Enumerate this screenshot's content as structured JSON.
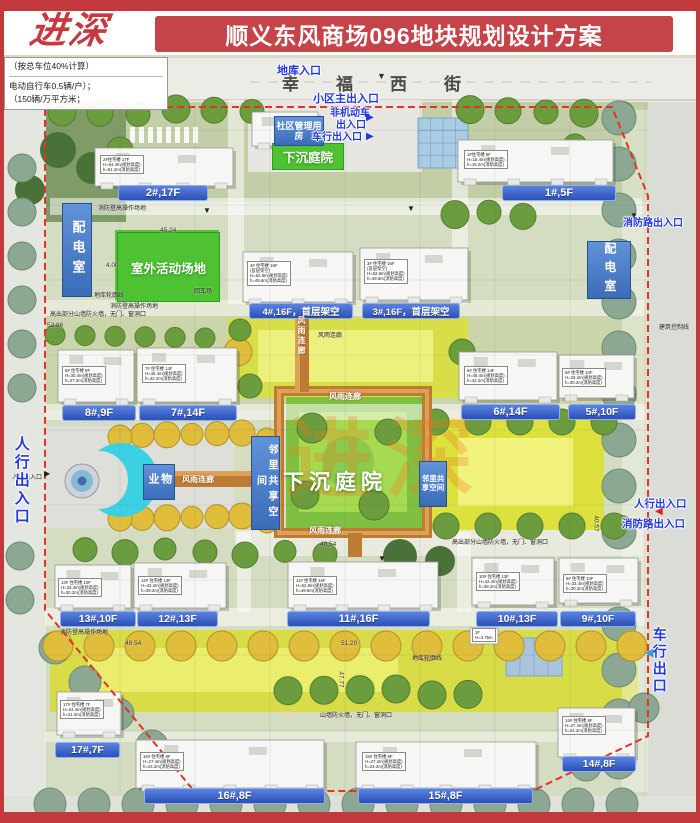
{
  "header": {
    "logo": "进深",
    "title": "顺义东风商场096地块规划设计方案"
  },
  "colors": {
    "frame_red": "#c2393c",
    "title_red": "#c5444a",
    "label_bar_blue": "#3a63cc",
    "entry_blue": "#2337e0",
    "corridor_orange": "#bd7c32",
    "facility_blue": "#4a7ac8",
    "green": "#4ec232",
    "watermark_orange": "#e67d19",
    "boundary_red": "#e63226",
    "gate_cyan": "#3ad2e2"
  },
  "plan": {
    "street_name": "幸福西街",
    "notes_panel": [
      "（按总车位40%计算）",
      "电动自行车0.5辆/户）；",
      "（150辆/万平方米；"
    ],
    "watermark": "进深",
    "building_labels": [
      {
        "t": "2#,17F",
        "x": 118,
        "y": 185,
        "w": 88,
        "fs": 11
      },
      {
        "t": "1#,5F",
        "x": 502,
        "y": 185,
        "w": 112,
        "fs": 11
      },
      {
        "t": "4#,16F，首层架空",
        "x": 249,
        "y": 303,
        "w": 102,
        "fs": 9.5
      },
      {
        "t": "3#,16F，首层架空",
        "x": 362,
        "y": 303,
        "w": 96,
        "fs": 9.5
      },
      {
        "t": "8#,9F",
        "x": 62,
        "y": 405,
        "w": 72,
        "fs": 11
      },
      {
        "t": "7#,14F",
        "x": 139,
        "y": 405,
        "w": 96,
        "fs": 11
      },
      {
        "t": "6#,14F",
        "x": 461,
        "y": 404,
        "w": 97,
        "fs": 11
      },
      {
        "t": "5#,10F",
        "x": 568,
        "y": 404,
        "w": 66,
        "fs": 10.5
      },
      {
        "t": "13#,10F",
        "x": 60,
        "y": 611,
        "w": 74,
        "fs": 10.5
      },
      {
        "t": "12#,13F",
        "x": 137,
        "y": 611,
        "w": 79,
        "fs": 10.5
      },
      {
        "t": "11#,16F",
        "x": 287,
        "y": 611,
        "w": 141,
        "fs": 11
      },
      {
        "t": "10#,13F",
        "x": 476,
        "y": 611,
        "w": 80,
        "fs": 10.5
      },
      {
        "t": "9#,10F",
        "x": 560,
        "y": 611,
        "w": 74,
        "fs": 10.5
      },
      {
        "t": "17#,7F",
        "x": 55,
        "y": 742,
        "w": 63,
        "fs": 10.5
      },
      {
        "t": "16#,8F",
        "x": 144,
        "y": 788,
        "w": 179,
        "fs": 11
      },
      {
        "t": "15#,8F",
        "x": 358,
        "y": 788,
        "w": 173,
        "fs": 11
      },
      {
        "t": "14#,8F",
        "x": 562,
        "y": 756,
        "w": 72,
        "fs": 10.5
      }
    ],
    "facility_labels": [
      {
        "t": "配电室",
        "x": 62,
        "y": 203,
        "w": 28,
        "h": 92,
        "v": 1,
        "fs": 13
      },
      {
        "t": "配电室",
        "x": 587,
        "y": 241,
        "w": 42,
        "h": 56,
        "v": 1,
        "fs": 12
      },
      {
        "t": "物业",
        "x": 143,
        "y": 464,
        "w": 30,
        "h": 34,
        "v": 1,
        "fs": 11
      },
      {
        "t": "社区管理用房",
        "x": 274,
        "y": 116,
        "w": 48,
        "h": 28,
        "fs": 9
      },
      {
        "t": "邻里共享空间",
        "x": 251,
        "y": 436,
        "w": 27,
        "h": 92,
        "v": 1,
        "fs": 10
      },
      {
        "t": "邻里共享空间",
        "x": 419,
        "y": 461,
        "w": 26,
        "h": 44,
        "fs": 7.5
      }
    ],
    "green_labels": [
      {
        "t": "下沉庭院",
        "x": 272,
        "y": 143,
        "w": 70,
        "h": 25,
        "fs": 12.5
      },
      {
        "t": "室外活动场地",
        "x": 117,
        "y": 232,
        "w": 101,
        "h": 68,
        "fs": 12.5
      }
    ],
    "courtyard_label": {
      "t": "下沉庭院"
    },
    "entrance_labels": [
      {
        "t": "地库入口",
        "x": 277,
        "y": 66,
        "fs": 11
      },
      {
        "t": "小区主出入口",
        "x": 313,
        "y": 94,
        "fs": 11
      },
      {
        "t": "非机动车",
        "x": 330,
        "y": 109,
        "fs": 10
      },
      {
        "t": "出入口",
        "x": 336,
        "y": 121,
        "fs": 10
      },
      {
        "t": "车行出入口",
        "x": 312,
        "y": 133,
        "fs": 10
      },
      {
        "t": "消防路出入口",
        "x": 623,
        "y": 219,
        "fs": 10
      },
      {
        "t": "人行出入口",
        "x": 13,
        "y": 436,
        "fs": 15,
        "v": 1,
        "h": 92
      },
      {
        "t": "人行出入口",
        "x": 634,
        "y": 499,
        "fs": 10.5
      },
      {
        "t": "消防路出入口",
        "x": 622,
        "y": 519,
        "fs": 10.5
      },
      {
        "t": "车行出口",
        "x": 652,
        "y": 627,
        "fs": 14,
        "v": 1,
        "h": 64
      }
    ],
    "corridor_labels": [
      {
        "t": "风雨连廊",
        "x": 329,
        "y": 391
      },
      {
        "t": "风雨连廊",
        "x": 309,
        "y": 525
      },
      {
        "t": "风雨连廊",
        "x": 182,
        "y": 474
      },
      {
        "t": "风雨连廊",
        "x": 296,
        "y": 316,
        "v": 1,
        "h": 56
      }
    ],
    "small_notes": [
      {
        "t": "消防登高操作场地",
        "x": 98,
        "y": 203
      },
      {
        "t": "消防登高操作场地",
        "x": 110,
        "y": 301
      },
      {
        "t": "消防登高操作场地",
        "x": 60,
        "y": 627
      },
      {
        "t": "地库轮廓线",
        "x": 94,
        "y": 290
      },
      {
        "t": "地库轮廓线",
        "x": 412,
        "y": 653
      },
      {
        "t": "高出部分山墙防火墙，无门、窗洞口",
        "x": 50,
        "y": 309
      },
      {
        "t": "高出部分山墙防火墙，无门、窗洞口",
        "x": 452,
        "y": 537
      },
      {
        "t": "山墙防火墙，无门、窗洞口",
        "x": 320,
        "y": 710
      },
      {
        "t": "建筑控制线",
        "x": 659,
        "y": 322
      },
      {
        "t": "回车场",
        "x": 194,
        "y": 286
      },
      {
        "t": "风雨连廊",
        "x": 318,
        "y": 330
      },
      {
        "t": "人行出入口",
        "x": 12,
        "y": 472
      }
    ],
    "dimensions": [
      {
        "t": "45.24",
        "x": 160,
        "y": 227
      },
      {
        "t": "52.86",
        "x": 47,
        "y": 322
      },
      {
        "t": "4.00",
        "x": 106,
        "y": 262
      },
      {
        "t": "48.54",
        "x": 125,
        "y": 640
      },
      {
        "t": "48.54",
        "x": 320,
        "y": 541
      },
      {
        "t": "51.20",
        "x": 341,
        "y": 640
      },
      {
        "t": "47.77",
        "x": 333,
        "y": 676,
        "r": 90
      },
      {
        "t": "40.57",
        "x": 588,
        "y": 520,
        "r": 90
      }
    ],
    "building_specs": [
      {
        "lines": [
          "2#住宅楼 17F",
          "H=54.4m(规划高度)",
          "h=51.2m(消防高度)"
        ],
        "x": 100,
        "y": 155
      },
      {
        "lines": [
          "1#住宅楼 5F",
          "H=18.4m(规划高度)",
          "h=15.2m(消防高度)"
        ],
        "x": 464,
        "y": 150
      },
      {
        "lines": [
          "4# 住宅楼 16F",
          "(首层架空)",
          "H=52.8m(规划高度)",
          "h=49.6m(消防高度)"
        ],
        "x": 247,
        "y": 261
      },
      {
        "lines": [
          "3# 住宅楼 16F",
          "(首层架空)",
          "H=52.8m(规划高度)",
          "h=49.6m(消防高度)"
        ],
        "x": 364,
        "y": 259
      },
      {
        "lines": [
          "8# 住宅楼 9F",
          "H=30.4m(规划高度)",
          "h=27.2m(消防高度)"
        ],
        "x": 62,
        "y": 366
      },
      {
        "lines": [
          "7# 住宅楼 14F",
          "H=45.4m(规划高度)",
          "h=42.2m(消防高度)"
        ],
        "x": 142,
        "y": 364
      },
      {
        "lines": [
          "6# 住宅楼 14F",
          "H=45.4m(规划高度)",
          "h=42.2m(消防高度)"
        ],
        "x": 464,
        "y": 366
      },
      {
        "lines": [
          "5# 住宅楼 10F",
          "H=33.4m(规划高度)",
          "h=30.2m(消防高度)"
        ],
        "x": 562,
        "y": 368
      },
      {
        "lines": [
          "13# 住宅楼 10F",
          "H=33.4m(规划高度)",
          "h=30.2m(消防高度)"
        ],
        "x": 58,
        "y": 578
      },
      {
        "lines": [
          "12# 住宅楼 13F",
          "H=42.4m(规划高度)",
          "h=39.2m(消防高度)"
        ],
        "x": 138,
        "y": 576
      },
      {
        "lines": [
          "11# 住宅楼 16F",
          "H=52.8m(规划高度)",
          "h=49.6m(消防高度)"
        ],
        "x": 293,
        "y": 576
      },
      {
        "lines": [
          "10# 住宅楼 13F",
          "H=42.4m(规划高度)",
          "h=39.2m(消防高度)"
        ],
        "x": 476,
        "y": 572
      },
      {
        "lines": [
          "9# 住宅楼 10F",
          "H=33.4m(规划高度)",
          "h=30.2m(消防高度)"
        ],
        "x": 563,
        "y": 574
      },
      {
        "lines": [
          "17# 住宅楼 7F",
          "H=24.4m(规划高度)",
          "h=21.2m(消防高度)"
        ],
        "x": 60,
        "y": 700
      },
      {
        "lines": [
          "16# 住宅楼 8F",
          "H=27.4m(规划高度)",
          "h=24.2m(消防高度)"
        ],
        "x": 140,
        "y": 752
      },
      {
        "lines": [
          "15# 住宅楼 8F",
          "H=27.4m(规划高度)",
          "h=24.2m(消防高度)"
        ],
        "x": 362,
        "y": 752
      },
      {
        "lines": [
          "14# 住宅楼 8F",
          "H=27.4m(规划高度)",
          "h=24.2m(消防高度)"
        ],
        "x": 562,
        "y": 716
      },
      {
        "lines": [
          "1F",
          "H=3.75m"
        ],
        "x": 472,
        "y": 628
      }
    ],
    "markers": [
      {
        "g": "▼",
        "x": 377,
        "y": 72,
        "fs": 9,
        "c": "#333"
      },
      {
        "g": "▶",
        "x": 366,
        "y": 113,
        "fs": 10,
        "c": "#2337e0"
      },
      {
        "g": "▶",
        "x": 366,
        "y": 132,
        "fs": 10,
        "c": "#2337e0"
      },
      {
        "g": "◀",
        "x": 655,
        "y": 507,
        "fs": 10,
        "c": "#e02020"
      },
      {
        "g": "◀",
        "x": 645,
        "y": 648,
        "fs": 11,
        "c": "#2d9fd8"
      },
      {
        "g": "▶",
        "x": 44,
        "y": 470,
        "fs": 8,
        "c": "#222"
      },
      {
        "g": "▼",
        "x": 203,
        "y": 207,
        "fs": 8,
        "c": "#222"
      },
      {
        "g": "▼",
        "x": 407,
        "y": 205,
        "fs": 8,
        "c": "#222"
      },
      {
        "g": "▼",
        "x": 630,
        "y": 212,
        "fs": 8,
        "c": "#222"
      },
      {
        "g": "▼",
        "x": 378,
        "y": 555,
        "fs": 8,
        "c": "#222"
      }
    ]
  }
}
